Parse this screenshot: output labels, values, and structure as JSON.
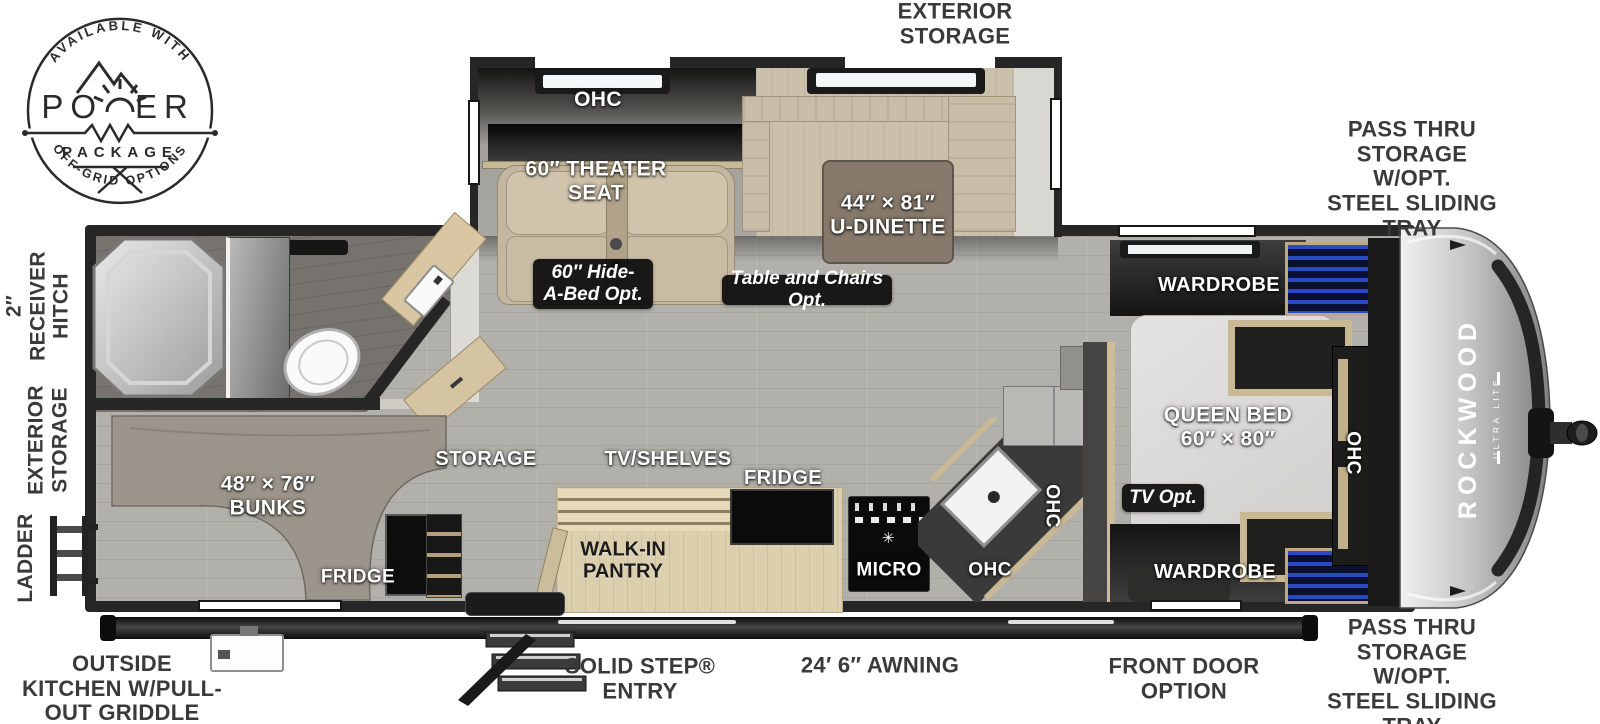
{
  "badge": {
    "top_text": "AVAILABLE WITH",
    "title_left": "PO",
    "title_right": "ER",
    "subtitle": "PACKAGE",
    "bottom_text": "OFF-GRID OPTIONS"
  },
  "brand": {
    "name": "ROCKWOOD",
    "sub": "ULTRA LITE"
  },
  "exterior_labels": {
    "top_storage": "EXTERIOR\nSTORAGE",
    "pass_thru_top": "PASS THRU\nSTORAGE W/OPT.\nSTEEL SLIDING TRAY",
    "pass_thru_bottom": "PASS THRU\nSTORAGE W/OPT.\nSTEEL SLIDING TRAY",
    "receiver_hitch": "2″\nRECEIVER\nHITCH",
    "left_storage": "EXTERIOR\nSTORAGE",
    "ladder": "LADDER",
    "outside_kitchen": "OUTSIDE\nKITCHEN W/PULL-\nOUT GRIDDLE",
    "solid_step": "SOLID STEP®\nENTRY",
    "awning": "24′ 6″ AWNING",
    "front_door": "FRONT DOOR\nOPTION"
  },
  "slideout": {
    "ohc": "OHC",
    "theater_seat": "60″ THEATER\nSEAT",
    "u_dinette": "44″ × 81″\nU-DINETTE",
    "hide_a_bed_opt": "60″ Hide-\nA-Bed Opt.",
    "table_chairs_opt": "Table and Chairs Opt."
  },
  "galley": {
    "storage": "STORAGE",
    "tv_shelves": "TV/SHELVES",
    "fridge": "FRIDGE",
    "walk_in_pantry": "WALK-IN\nPANTRY",
    "micro": "MICRO",
    "ohc_sink": "OHC",
    "ohc_side": "OHC"
  },
  "bedroom": {
    "wardrobe_top": "WARDROBE",
    "wardrobe_bottom": "WARDROBE",
    "queen_bed": "QUEEN BED\n60″ × 80″",
    "ohc": "OHC",
    "tv_opt": "TV Opt."
  },
  "bunkroom": {
    "bunks": "48″ × 76″\nBUNKS",
    "fridge": "FRIDGE"
  },
  "icons": {
    "burner": "✳"
  },
  "colors": {
    "wall": "#262626",
    "floor": "#b2b0ab",
    "bath_floor": "#76726d",
    "tan_furniture": "#c8bda7",
    "wood": "#dccfae",
    "carpet": "#9c958b",
    "appliance_black": "#111111",
    "accent_blue": "#2a49c4",
    "label_dark": "#3a3a3a",
    "cap_silver": "#c4c4c4"
  }
}
